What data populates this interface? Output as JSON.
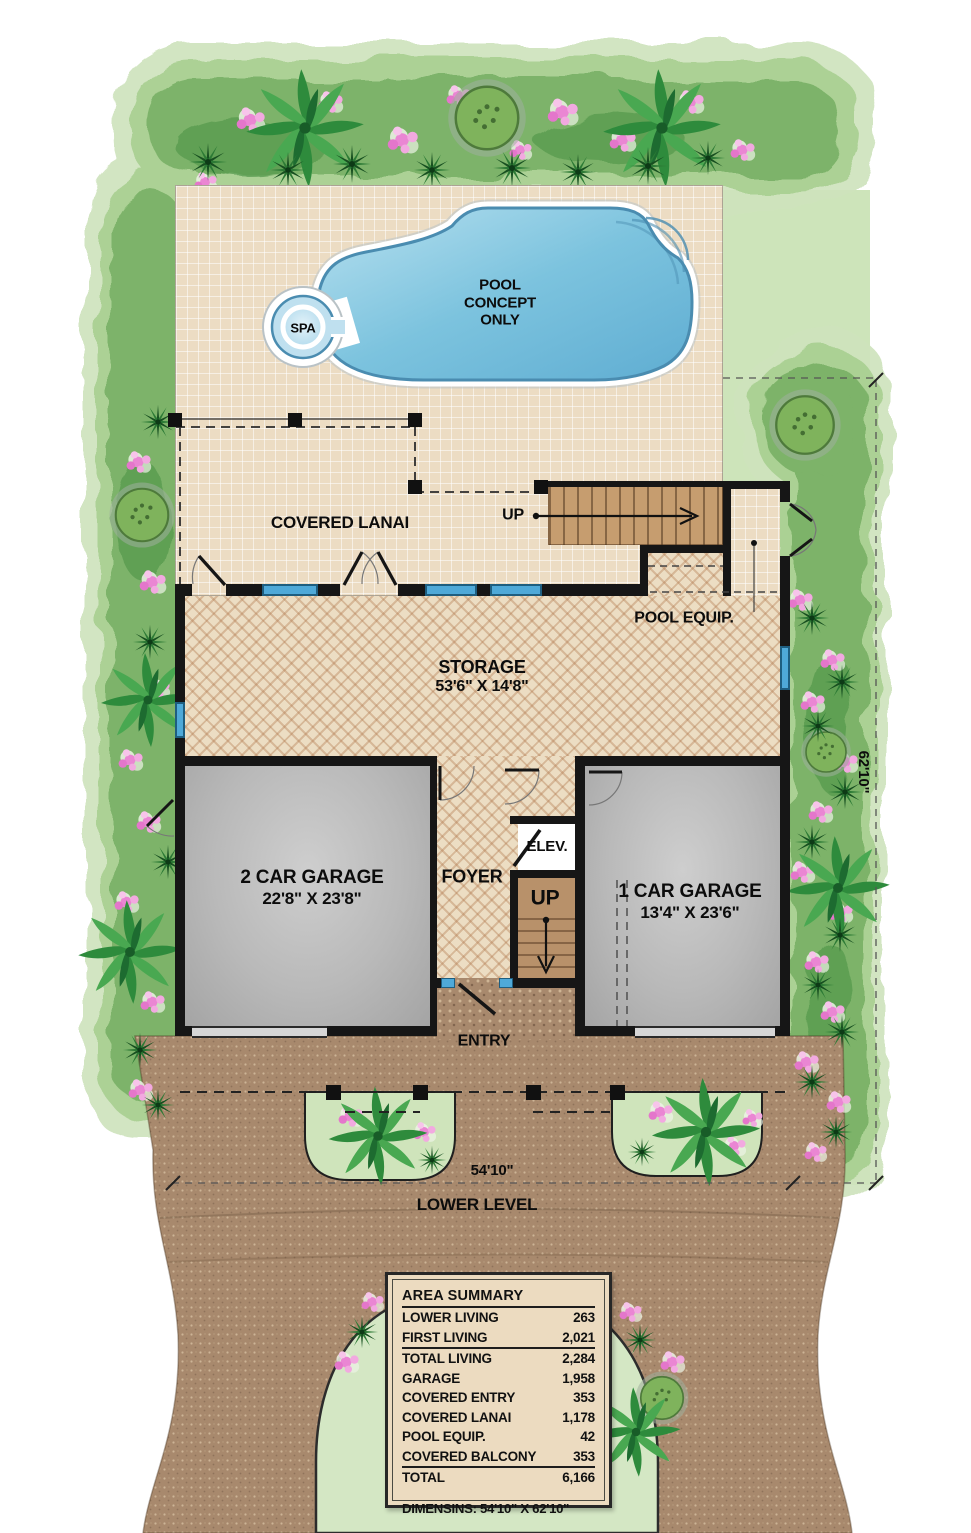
{
  "labels": {
    "covered_lanai": "COVERED LANAI",
    "pool_line1": "POOL",
    "pool_line2": "CONCEPT",
    "pool_line3": "ONLY",
    "spa": "SPA",
    "up_upper": "UP",
    "up_lower": "UP",
    "pool_equip": "POOL EQUIP.",
    "storage_name": "STORAGE",
    "storage_dim": "53'6\" X 14'8\"",
    "garage2_name": "2 CAR GARAGE",
    "garage2_dim": "22'8\" X 23'8\"",
    "garage1_name": "1 CAR GARAGE",
    "garage1_dim": "13'4\" X 23'6\"",
    "foyer": "FOYER",
    "elevator": "ELEV.",
    "entry": "ENTRY",
    "lower_level": "LOWER LEVEL",
    "dim_width": "54'10\"",
    "dim_height": "62'10\""
  },
  "area_summary": {
    "title": "AREA SUMMARY",
    "rows": [
      {
        "label": "LOWER LIVING",
        "value": "263"
      },
      {
        "label": "FIRST LIVING",
        "value": "2,021"
      },
      {
        "label": "TOTAL LIVING",
        "value": "2,284"
      },
      {
        "label": "GARAGE",
        "value": "1,958"
      },
      {
        "label": "COVERED ENTRY",
        "value": "353"
      },
      {
        "label": "COVERED LANAI",
        "value": "1,178"
      },
      {
        "label": "POOL EQUIP.",
        "value": "42"
      },
      {
        "label": "COVERED BALCONY",
        "value": "353"
      },
      {
        "label": "TOTAL",
        "value": "6,166"
      }
    ],
    "dimensions_note": "DIMENSINS: 54'10\" X 62'10\""
  },
  "colors": {
    "pool_water": "#6fbddc",
    "garden_green": "#7ab167",
    "lawn_green": "#cde4ba",
    "paver_brown": "#a8896d",
    "wall_black": "#161616",
    "window_blue": "#4fa9d8",
    "stair_wood": "#c69d6f",
    "deck_tan": "#ecdcc3",
    "table_bg": "#ecdbc0"
  }
}
